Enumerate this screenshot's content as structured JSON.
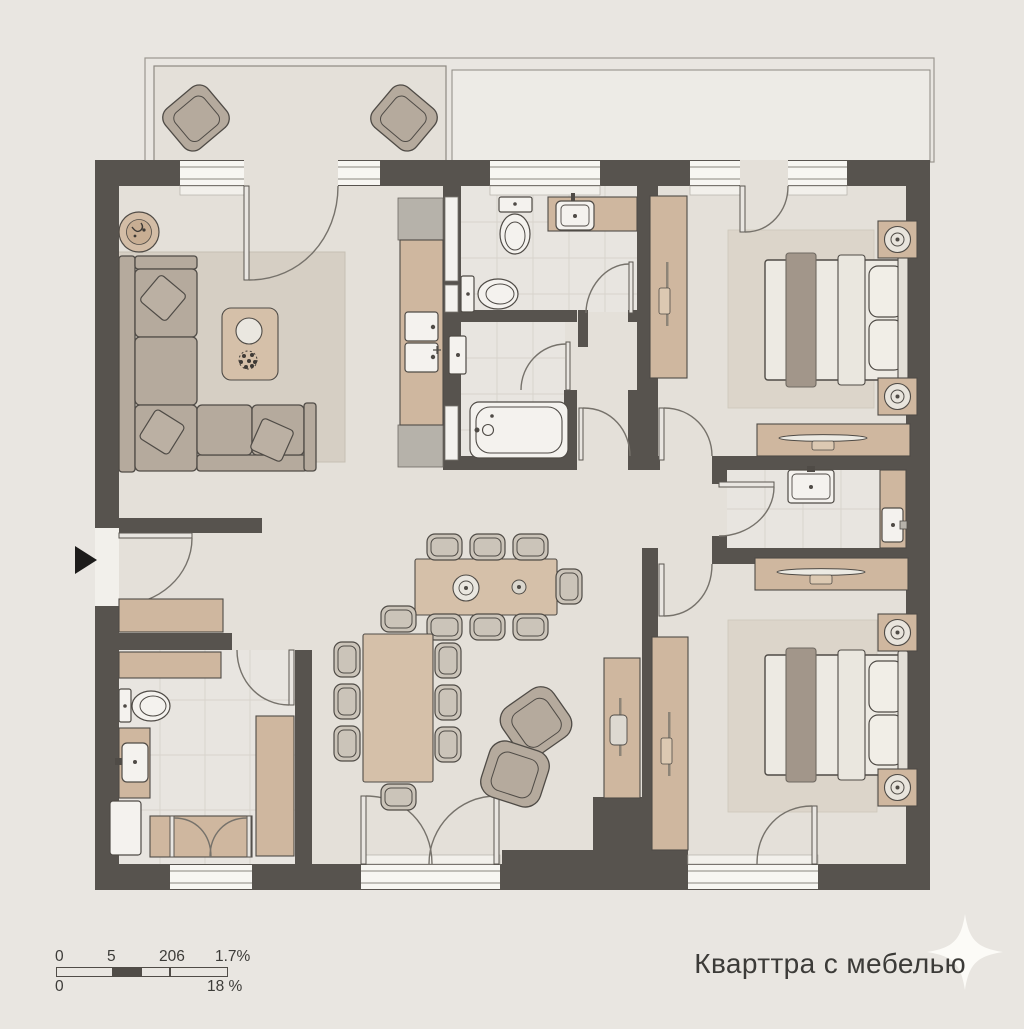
{
  "title": "Кварттра с мебелью",
  "scale_bar": {
    "row1": [
      "0",
      "5",
      "206",
      "1.7%"
    ],
    "row2": [
      "0",
      "18 %"
    ]
  },
  "colors": {
    "bg": "#e9e6e1",
    "floor": "#e4e0d9",
    "tile": "#e8e5e0",
    "tileline": "#d7d3cc",
    "wall": "#57534e",
    "wood": "#cfb79f",
    "woodlight": "#d5c0a9",
    "upholstery": "#b5aa9d",
    "rug": "#d6cfc4",
    "rugbed": "#dcd5ca",
    "runner": "#a2968a",
    "fixture": "#f4f2ee",
    "line": "#4f4b46",
    "window": "#f7f6f2",
    "arc": "#76726b",
    "leaf": "#e9e6e1",
    "gray": "#b6b2aa",
    "text": "#3c3b38",
    "sparkle": "#fcfbf7",
    "arrow": "#1d1c1b"
  }
}
